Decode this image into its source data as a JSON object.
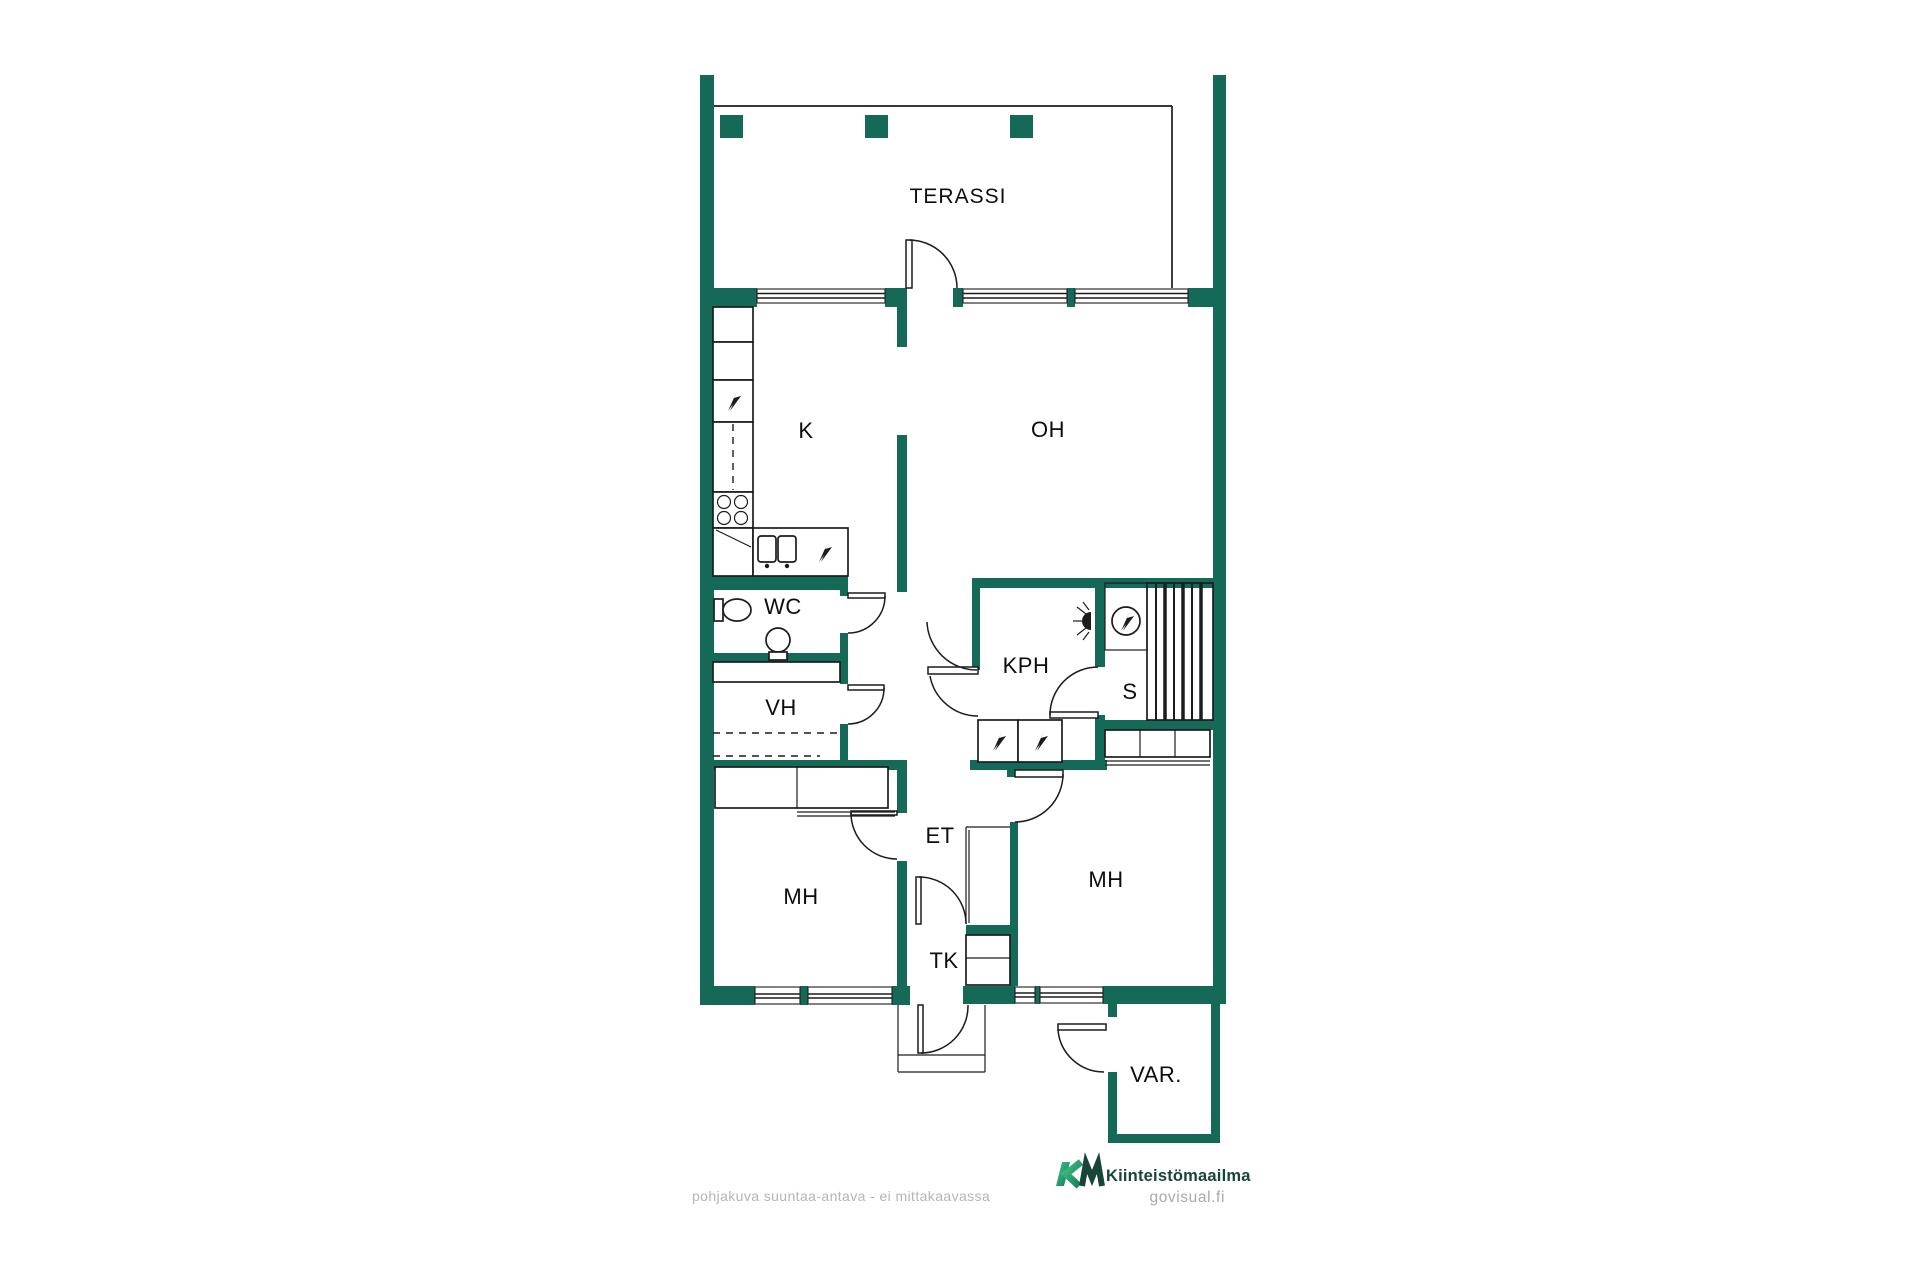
{
  "page": {
    "background": "#ffffff",
    "description": "apartment floor plan"
  },
  "colors": {
    "wall": "#156a57",
    "line": "#1c1c1c",
    "label": "#0d0d0d",
    "caption_gray": "#b5b5b5",
    "brand_dark": "#17453a",
    "brand_green": "#3ec487",
    "govisual_gray": "#a9a9a9"
  },
  "rooms": {
    "terrace": "TERASSI",
    "kitchen": "K",
    "living": "OH",
    "toilet": "WC",
    "closet": "VH",
    "bathroom": "KPH",
    "sauna": "S",
    "entry": "ET",
    "vestibule": "TK",
    "bedroom_left": "MH",
    "bedroom_right": "MH",
    "storage": "VAR."
  },
  "symbols": {
    "electric_appliance": "lightning-bolt",
    "sauna_heater": "circle-with-lightning-bolt",
    "shower": "spray-fan",
    "stove": "four-burner-circles"
  },
  "footer": {
    "disclaimer": "pohjakuva suuntaa-antava - ei mittakaavassa",
    "brand_mark": "KM",
    "brand_name": "Kiinteistömaailma",
    "watermark": "govisual.fi"
  }
}
